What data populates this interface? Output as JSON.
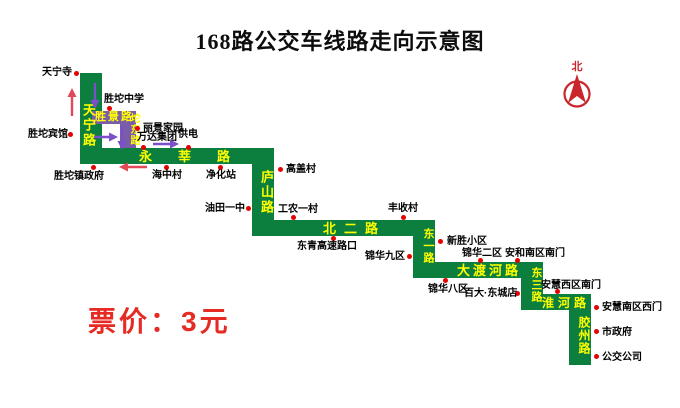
{
  "title": "168路公交车线路走向示意图",
  "fare": "票价：3元",
  "compass": {
    "label": "北"
  },
  "colors": {
    "route_green": "#0c7e3e",
    "detour_purple": "#7a5ca8",
    "road_text_yellow": "#ffff00",
    "stop_dot_red": "#e60000",
    "arrow_purple": "#7b4fc9",
    "arrow_red": "#e04a58",
    "fare_red": "#e52b24",
    "compass_red": "#c9252b",
    "title_black": "#0d0d0d",
    "stop_label_black": "#000000"
  },
  "roads": [
    {
      "name": "天宁路",
      "type": "main",
      "orient": "v",
      "bar": [
        80,
        73,
        22,
        91
      ],
      "label": [
        78,
        103
      ],
      "fs": 13,
      "ls": 2
    },
    {
      "name": "胜景路",
      "type": "detour",
      "orient": "h",
      "bar": [
        92,
        111,
        44,
        13
      ],
      "label": [
        95,
        112
      ],
      "fs": 11,
      "ls": 2
    },
    {
      "name": "坨东路",
      "type": "detour",
      "orient": "v",
      "bar": [
        120,
        111,
        16,
        37
      ],
      "label": [
        124,
        113
      ],
      "fs": 10,
      "ls": 1
    },
    {
      "name": "永莘路",
      "type": "main",
      "orient": "h",
      "bar": [
        80,
        148,
        194,
        16
      ],
      "label": [
        139,
        150
      ],
      "fs": 13,
      "ls": 26
    },
    {
      "name": "庐山路",
      "type": "main",
      "orient": "v",
      "bar": [
        252,
        148,
        22,
        88
      ],
      "label": [
        256,
        170
      ],
      "fs": 13,
      "ls": 2
    },
    {
      "name": "北二路",
      "type": "main",
      "orient": "h",
      "bar": [
        252,
        220,
        183,
        16
      ],
      "label": [
        323,
        222
      ],
      "fs": 13,
      "ls": 8
    },
    {
      "name": "东一路",
      "type": "main",
      "orient": "v",
      "bar": [
        413,
        220,
        22,
        58
      ],
      "label": [
        418,
        228
      ],
      "fs": 11,
      "ls": 1
    },
    {
      "name": "大渡河路",
      "type": "main",
      "orient": "h",
      "bar": [
        413,
        262,
        130,
        16
      ],
      "label": [
        457,
        264
      ],
      "fs": 13,
      "ls": 3
    },
    {
      "name": "东三路",
      "type": "main",
      "orient": "v",
      "bar": [
        521,
        262,
        22,
        48
      ],
      "label": [
        526,
        267
      ],
      "fs": 11,
      "ls": 1
    },
    {
      "name": "淮河路",
      "type": "main",
      "orient": "h",
      "bar": [
        521,
        294,
        70,
        16
      ],
      "label": [
        542,
        297
      ],
      "fs": 12,
      "ls": 4
    },
    {
      "name": "胶州路",
      "type": "main",
      "orient": "v",
      "bar": [
        569,
        294,
        22,
        71
      ],
      "label": [
        574,
        316
      ],
      "fs": 12,
      "ls": 1
    }
  ],
  "stops": [
    {
      "name": "天宁寺",
      "label": [
        42,
        67
      ],
      "dot": [
        76,
        73
      ]
    },
    {
      "name": "胜坨中学",
      "label": [
        104,
        94
      ],
      "dot": [
        109,
        108
      ]
    },
    {
      "name": "胜坨宾馆",
      "label": [
        28,
        129
      ],
      "dot": [
        70,
        134
      ]
    },
    {
      "name": "丽景家园",
      "label": [
        143,
        123
      ],
      "dot": [
        137,
        128
      ]
    },
    {
      "name": "万达集团",
      "label": [
        137,
        132
      ],
      "dot": [
        143,
        147
      ]
    },
    {
      "name": "供电",
      "label": [
        178,
        129
      ],
      "dot": [
        188,
        147
      ]
    },
    {
      "name": "胜坨镇政府",
      "label": [
        54,
        171
      ],
      "dot": [
        93,
        167
      ]
    },
    {
      "name": "海中村",
      "label": [
        152,
        170
      ],
      "dot": [
        166,
        167
      ]
    },
    {
      "name": "净化站",
      "label": [
        206,
        170
      ],
      "dot": [
        220,
        167
      ]
    },
    {
      "name": "高盖村",
      "label": [
        286,
        164
      ],
      "dot": [
        280,
        169
      ]
    },
    {
      "name": "油田一中",
      "label": [
        205,
        203
      ],
      "dot": [
        248,
        208
      ]
    },
    {
      "name": "工农一村",
      "label": [
        278,
        204
      ],
      "dot": [
        293,
        217
      ]
    },
    {
      "name": "东青高速路口",
      "label": [
        297,
        241
      ],
      "dot": [
        333,
        238
      ]
    },
    {
      "name": "丰收村",
      "label": [
        388,
        203
      ],
      "dot": [
        403,
        217
      ]
    },
    {
      "name": "锦华九区",
      "label": [
        365,
        251
      ],
      "dot": [
        409,
        256
      ]
    },
    {
      "name": "新胜小区",
      "label": [
        447,
        236
      ],
      "dot": [
        440,
        241
      ]
    },
    {
      "name": "锦华二区",
      "label": [
        462,
        248
      ],
      "dot": [
        480,
        260
      ]
    },
    {
      "name": "安和南区南门",
      "label": [
        505,
        248
      ],
      "dot": [
        517,
        260
      ]
    },
    {
      "name": "锦华八区",
      "label": [
        428,
        284
      ],
      "dot": [
        445,
        280
      ]
    },
    {
      "name": "百大·东城店",
      "label": [
        464,
        288
      ],
      "dot": [
        517,
        293
      ]
    },
    {
      "name": "安慧西区南门",
      "label": [
        541,
        280
      ],
      "dot": [
        557,
        291
      ]
    },
    {
      "name": "安慧南区西门",
      "label": [
        602,
        302
      ],
      "dot": [
        596,
        307
      ]
    },
    {
      "name": "市政府",
      "label": [
        602,
        327
      ],
      "dot": [
        596,
        331
      ]
    },
    {
      "name": "公交公司",
      "label": [
        602,
        352
      ],
      "dot": [
        596,
        356
      ]
    }
  ],
  "arrows": [
    {
      "dir": "up",
      "len": 30,
      "color": "red",
      "x": 66,
      "y": 87
    },
    {
      "dir": "down",
      "len": 28,
      "color": "purple",
      "x": 89,
      "y": 82
    },
    {
      "dir": "right",
      "len": 26,
      "color": "purple",
      "x": 93,
      "y": 131
    },
    {
      "dir": "down",
      "len": 26,
      "color": "purple",
      "x": 116,
      "y": 125
    },
    {
      "dir": "right",
      "len": 28,
      "color": "purple",
      "x": 152,
      "y": 138
    },
    {
      "dir": "left",
      "len": 30,
      "color": "red",
      "x": 118,
      "y": 161
    }
  ]
}
